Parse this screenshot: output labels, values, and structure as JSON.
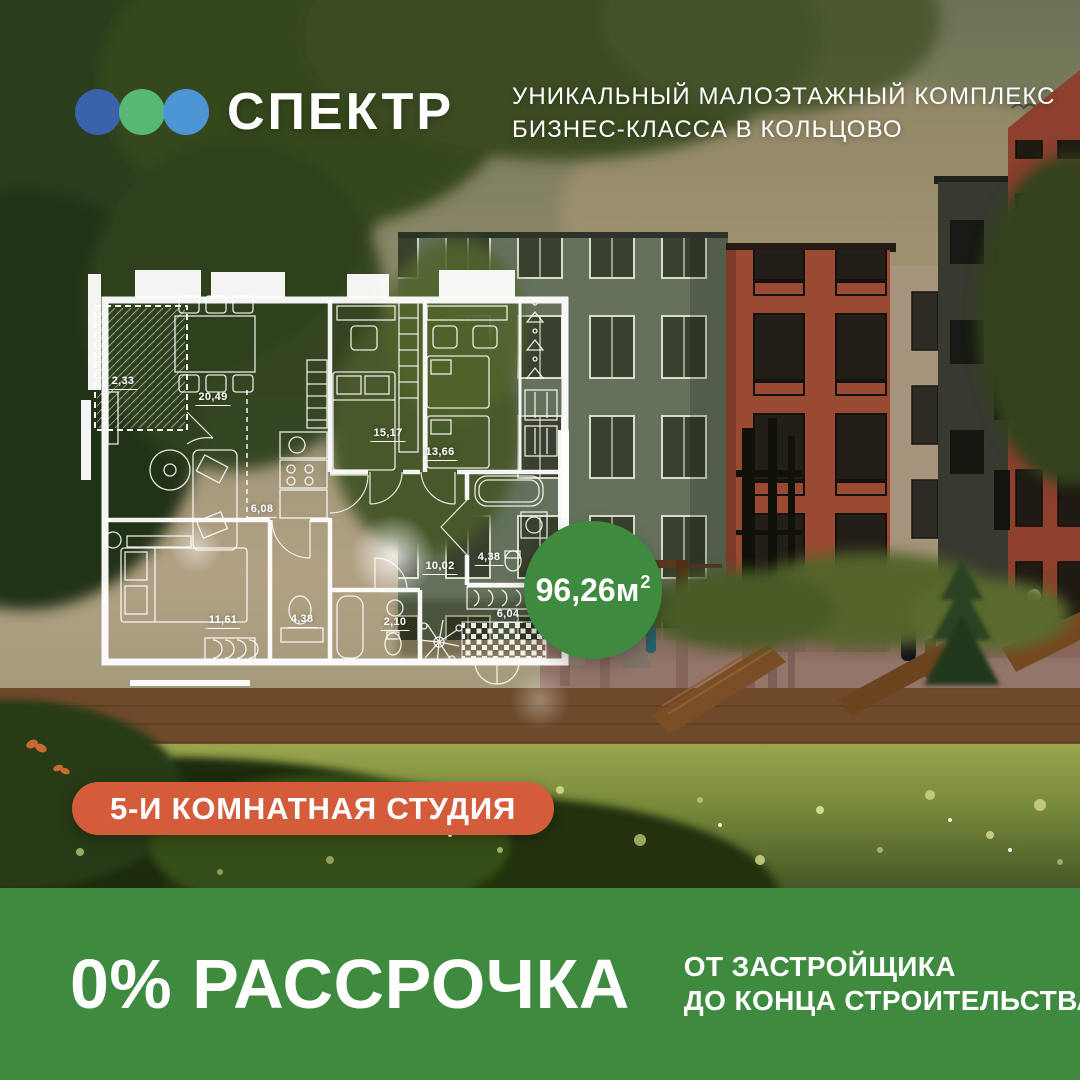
{
  "header": {
    "logo": {
      "text": "СПЕКТР"
    },
    "tagline_line1": "УНИКАЛЬНЫЙ МАЛОЭТАЖНЫЙ КОМПЛЕКС",
    "tagline_line2": "БИЗНЕС-КЛАССА В КОЛЬЦОВО"
  },
  "floorplan": {
    "rooms": [
      {
        "name": "balcony",
        "area": "2,33"
      },
      {
        "name": "living-room",
        "area": "20,49"
      },
      {
        "name": "bedroom-middle",
        "area": "15,17"
      },
      {
        "name": "bedroom-right",
        "area": "13,66"
      },
      {
        "name": "kitchen",
        "area": "6,08"
      },
      {
        "name": "bedroom-left",
        "area": "11,61"
      },
      {
        "name": "dressing-room",
        "area": "4,38"
      },
      {
        "name": "wc",
        "area": "2,10"
      },
      {
        "name": "hall",
        "area": "10,02"
      },
      {
        "name": "bathroom",
        "area": "4,38"
      },
      {
        "name": "loggia",
        "area": "6,04"
      }
    ],
    "total_area": {
      "value": "96,26м",
      "sup": "2"
    }
  },
  "badges": {
    "apartment_type": "5-И КОМНАТНАЯ СТУДИЯ"
  },
  "footer": {
    "offer": "0% РАССРОЧКА",
    "note_line1": "ОТ ЗАСТРОЙЩИКА",
    "note_line2": "ДО КОНЦА СТРОИТЕЛЬСТВА"
  },
  "colors": {
    "accent_green": "#3e8a3e",
    "badge_orange": "#d55c3b",
    "dot_blue": "#3a63a9",
    "dot_green": "#56b873",
    "dot_light_blue": "#4d96d5",
    "plan_lines": "#ffffff"
  },
  "icons": {
    "logo-dot-icon": "filled circle",
    "bird-icon": "gull curve stroke",
    "butterfly-icon": "orange wing ellipses"
  }
}
